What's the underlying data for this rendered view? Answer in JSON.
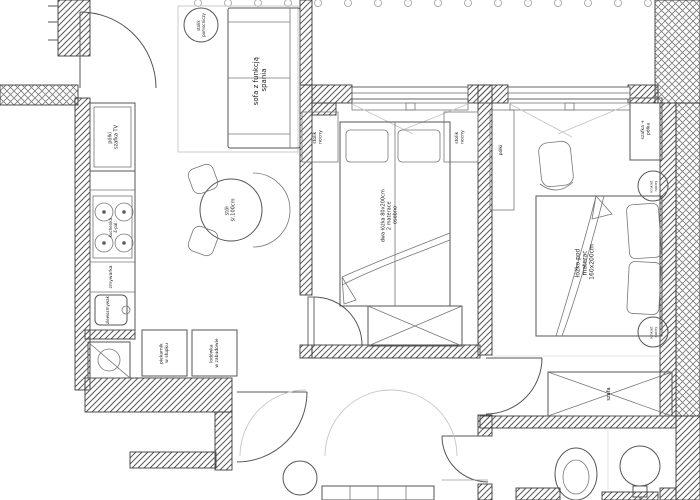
{
  "meta": {
    "type": "architectural floor plan",
    "language": "pl"
  },
  "colors": {
    "wall_line": "#3a3a3a",
    "furniture_line": "#555555",
    "light_line": "#c6c6c6",
    "text": "#1d1d1d",
    "background": "#ffffff"
  },
  "living_kitchen": {
    "side_table": [
      "stolik",
      "pomocniczy"
    ],
    "sofa": [
      "sofa z funkcją",
      "spania"
    ],
    "tv_cabinet": [
      "półki",
      "szafka TV"
    ],
    "stove": [
      "kuchenka",
      "4-pal."
    ],
    "dishwasher": [
      "zmywarka"
    ],
    "sink": [
      "zlewozmywak"
    ],
    "dining_table": [
      "stół",
      "śr.100cm"
    ],
    "oven_column": [
      "piekarnik",
      "w słupku"
    ],
    "fridge": [
      "lodówka",
      "w zabudowie"
    ]
  },
  "bedroom_middle": {
    "nightstand_left": [
      "stolik",
      "nocny"
    ],
    "nightstand_right": [
      "stolik",
      "nocny"
    ],
    "beds": [
      "dwa łóżka 80x200cm",
      "2 materace",
      "osobno"
    ]
  },
  "bedroom_right": {
    "shelves": [
      "półki"
    ],
    "cabinet_shelves": [
      "szafka +",
      "półka"
    ],
    "sconce_top": [
      "kinkiet",
      "nocny"
    ],
    "sconce_bottom": [
      "kinkiet",
      "nocny"
    ],
    "bed": [
      "łóżko pod",
      "materac",
      "160x200cm"
    ],
    "wardrobe": [
      "szafa"
    ]
  }
}
